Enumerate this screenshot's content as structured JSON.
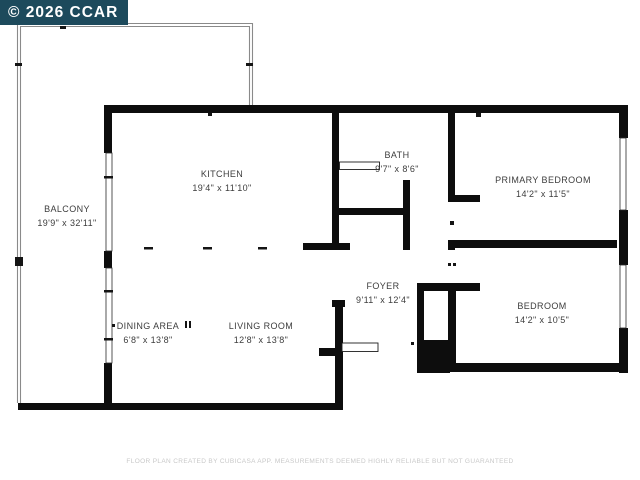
{
  "watermark": {
    "text": "© 2026 CCAR"
  },
  "rooms": [
    {
      "id": "balcony",
      "label": "BALCONY",
      "dims": "19'9\" x 32'11\""
    },
    {
      "id": "kitchen",
      "label": "KITCHEN",
      "dims": "19'4\" x 11'10\""
    },
    {
      "id": "bath",
      "label": "BATH",
      "dims": "9'7\" x 8'6\""
    },
    {
      "id": "primary-bedroom",
      "label": "PRIMARY BEDROOM",
      "dims": "14'2\" x 11'5\""
    },
    {
      "id": "foyer",
      "label": "FOYER",
      "dims": "9'11\" x 12'4\""
    },
    {
      "id": "bedroom",
      "label": "BEDROOM",
      "dims": "14'2\" x 10'5\""
    },
    {
      "id": "dining-area",
      "label": "DINING AREA",
      "dims": "6'8\" x 13'8\""
    },
    {
      "id": "living-room",
      "label": "LIVING ROOM",
      "dims": "12'8\" x 13'8\""
    }
  ],
  "disclaimer": "FLOOR PLAN CREATED BY CUBICASA APP. MEASUREMENTS DEEMED HIGHLY RELIABLE BUT NOT GUARANTEED",
  "colors": {
    "background": "#ffffff",
    "wall": "#0d0d0d",
    "balcony_line": "#8a8a8a",
    "label_text": "#3d3d3d",
    "disclaimer_text": "#c8c8c8",
    "watermark_bg": "#1d4a5c",
    "watermark_text": "#ffffff"
  }
}
